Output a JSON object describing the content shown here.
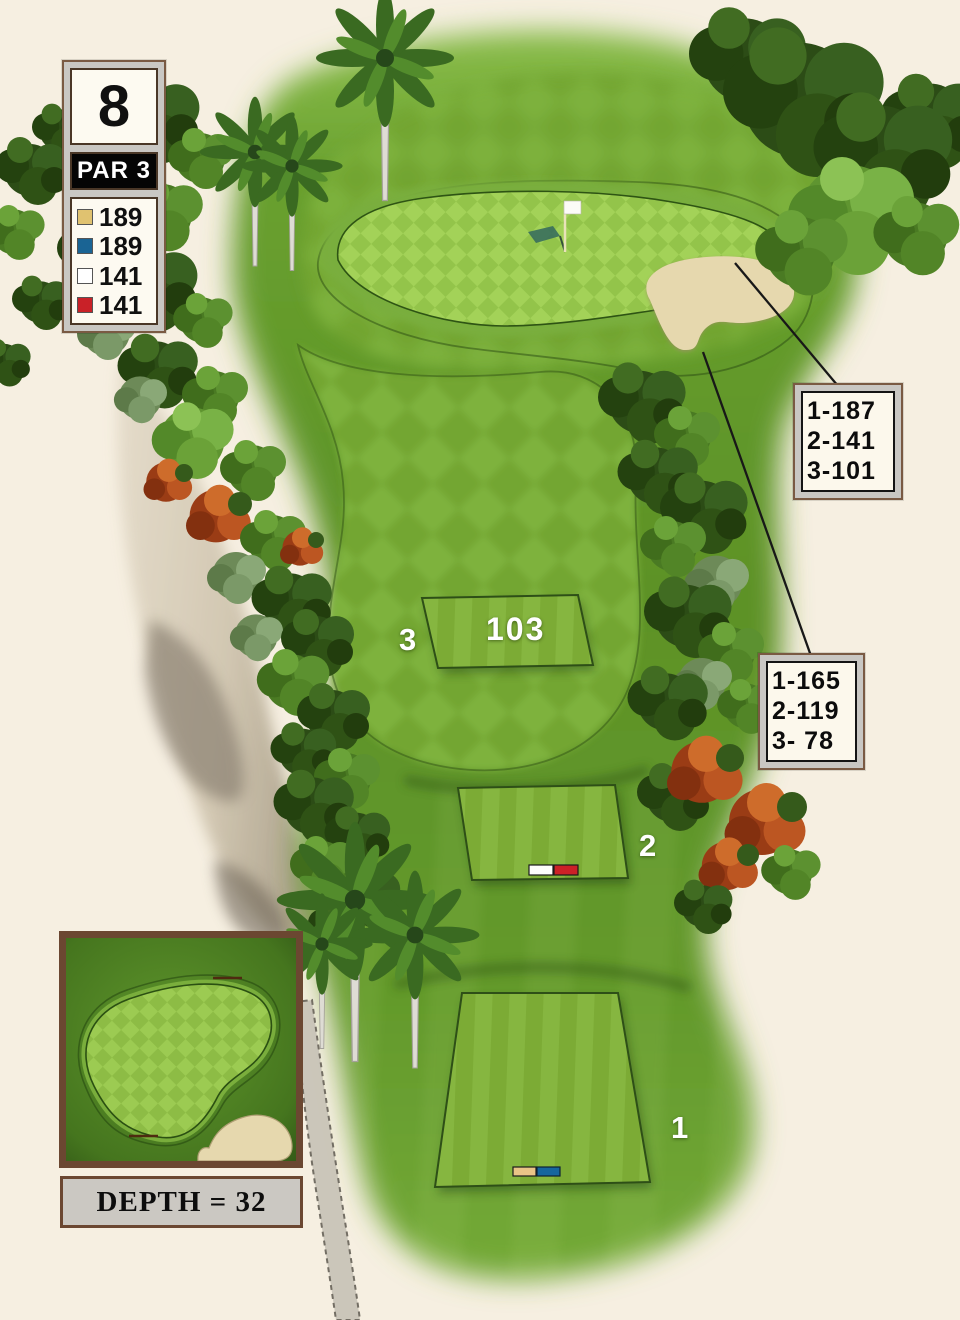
{
  "title": "Golf hole yardage map",
  "hole": {
    "number": "8",
    "par_label": "PAR 3"
  },
  "tee_legend": [
    {
      "tee": "gold",
      "color": "#e0c270",
      "yardage": "189"
    },
    {
      "tee": "blue",
      "color": "#1a6494",
      "yardage": "189"
    },
    {
      "tee": "white",
      "color": "#ffffff",
      "yardage": "141"
    },
    {
      "tee": "red",
      "color": "#c92128",
      "yardage": "141"
    }
  ],
  "distance_callouts": [
    {
      "lines": [
        "1-187",
        "2-141",
        "3-101"
      ]
    },
    {
      "lines": [
        "1-165",
        "2-119",
        "3- 78"
      ]
    }
  ],
  "tee_boxes": [
    {
      "label": "1",
      "marker_colors": [
        "#e9c487",
        "#16669e"
      ]
    },
    {
      "label": "2",
      "marker_colors": [
        "#fdfdfb",
        "#cc2127"
      ]
    },
    {
      "label": "3",
      "distance": "103"
    }
  ],
  "green_inset": {
    "depth_label": "DEPTH = 32"
  },
  "colors": {
    "background": "#f6efe1",
    "panel_border": "#6b4731",
    "panel_gray": "#c9c7c3",
    "fairway_light": "#7eb23c",
    "fairway_dark": "#73a631",
    "rough": "#5d9227",
    "green_light": "#a3d258",
    "green_dark": "#93c44a",
    "sand": "#e6d8ae",
    "callout_bg": "#fcf8ec",
    "flag": "#ffffff"
  }
}
